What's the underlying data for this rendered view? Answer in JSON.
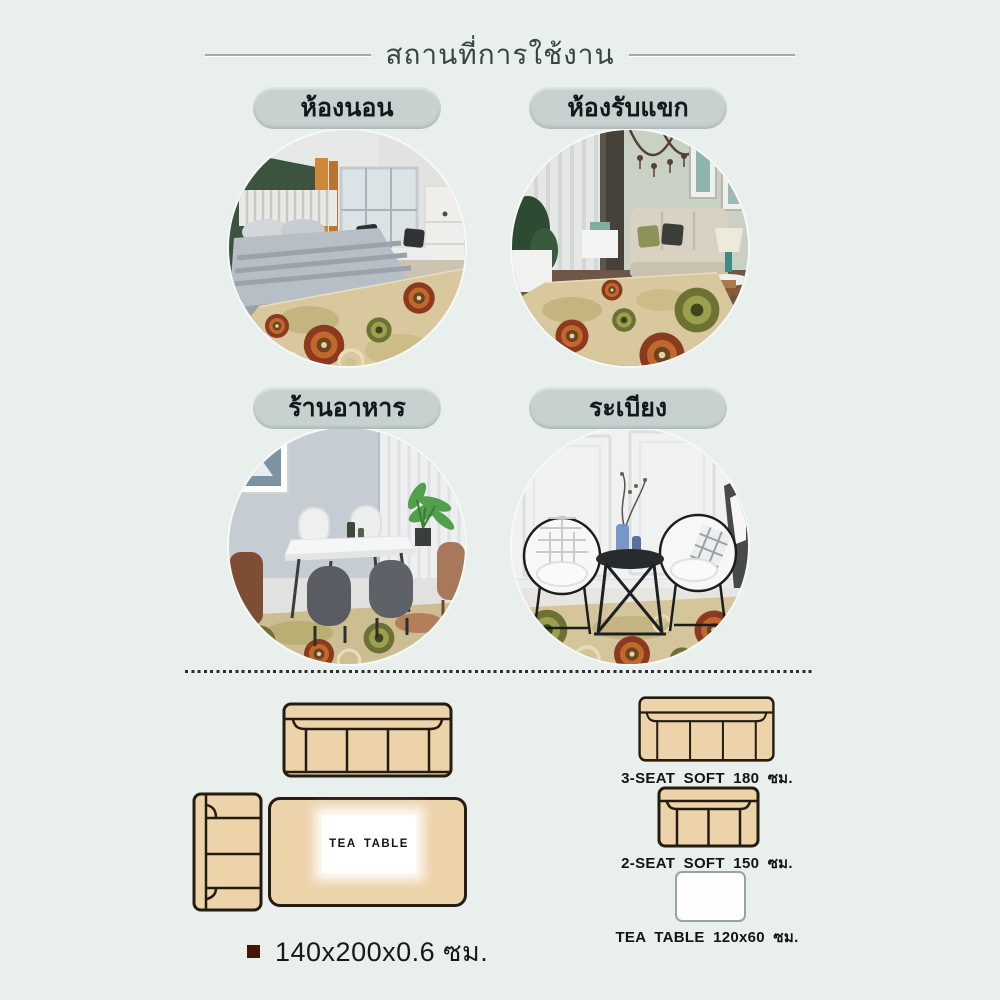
{
  "header": {
    "title": "สถานที่การใช้งาน"
  },
  "usage": {
    "items": [
      {
        "label": "ห้องนอน",
        "scene": "bedroom"
      },
      {
        "label": "ห้องรับแขก",
        "scene": "living-room"
      },
      {
        "label": "ร้านอาหาร",
        "scene": "dining-room"
      },
      {
        "label": "ระเบียง",
        "scene": "balcony"
      }
    ]
  },
  "layout_plan": {
    "tea_table_label": "TEA TABLE",
    "size_label": "140x200x0.6 ซม."
  },
  "legend": {
    "items": [
      {
        "label": "3-SEAT SOFT 180 ซม.",
        "shape": "sofa-3-seat"
      },
      {
        "label": "2-SEAT SOFT 150 ซม.",
        "shape": "sofa-2-seat"
      },
      {
        "label": "TEA TABLE 120x60 ซม.",
        "shape": "tea-table"
      }
    ]
  },
  "colors": {
    "background": "#e9efec",
    "pill": "#c7d2d0",
    "sofa_fill": "#ecd3aa",
    "sofa_outline": "#241c12",
    "bullet": "#461509",
    "rug_base": "#d9c89d"
  }
}
